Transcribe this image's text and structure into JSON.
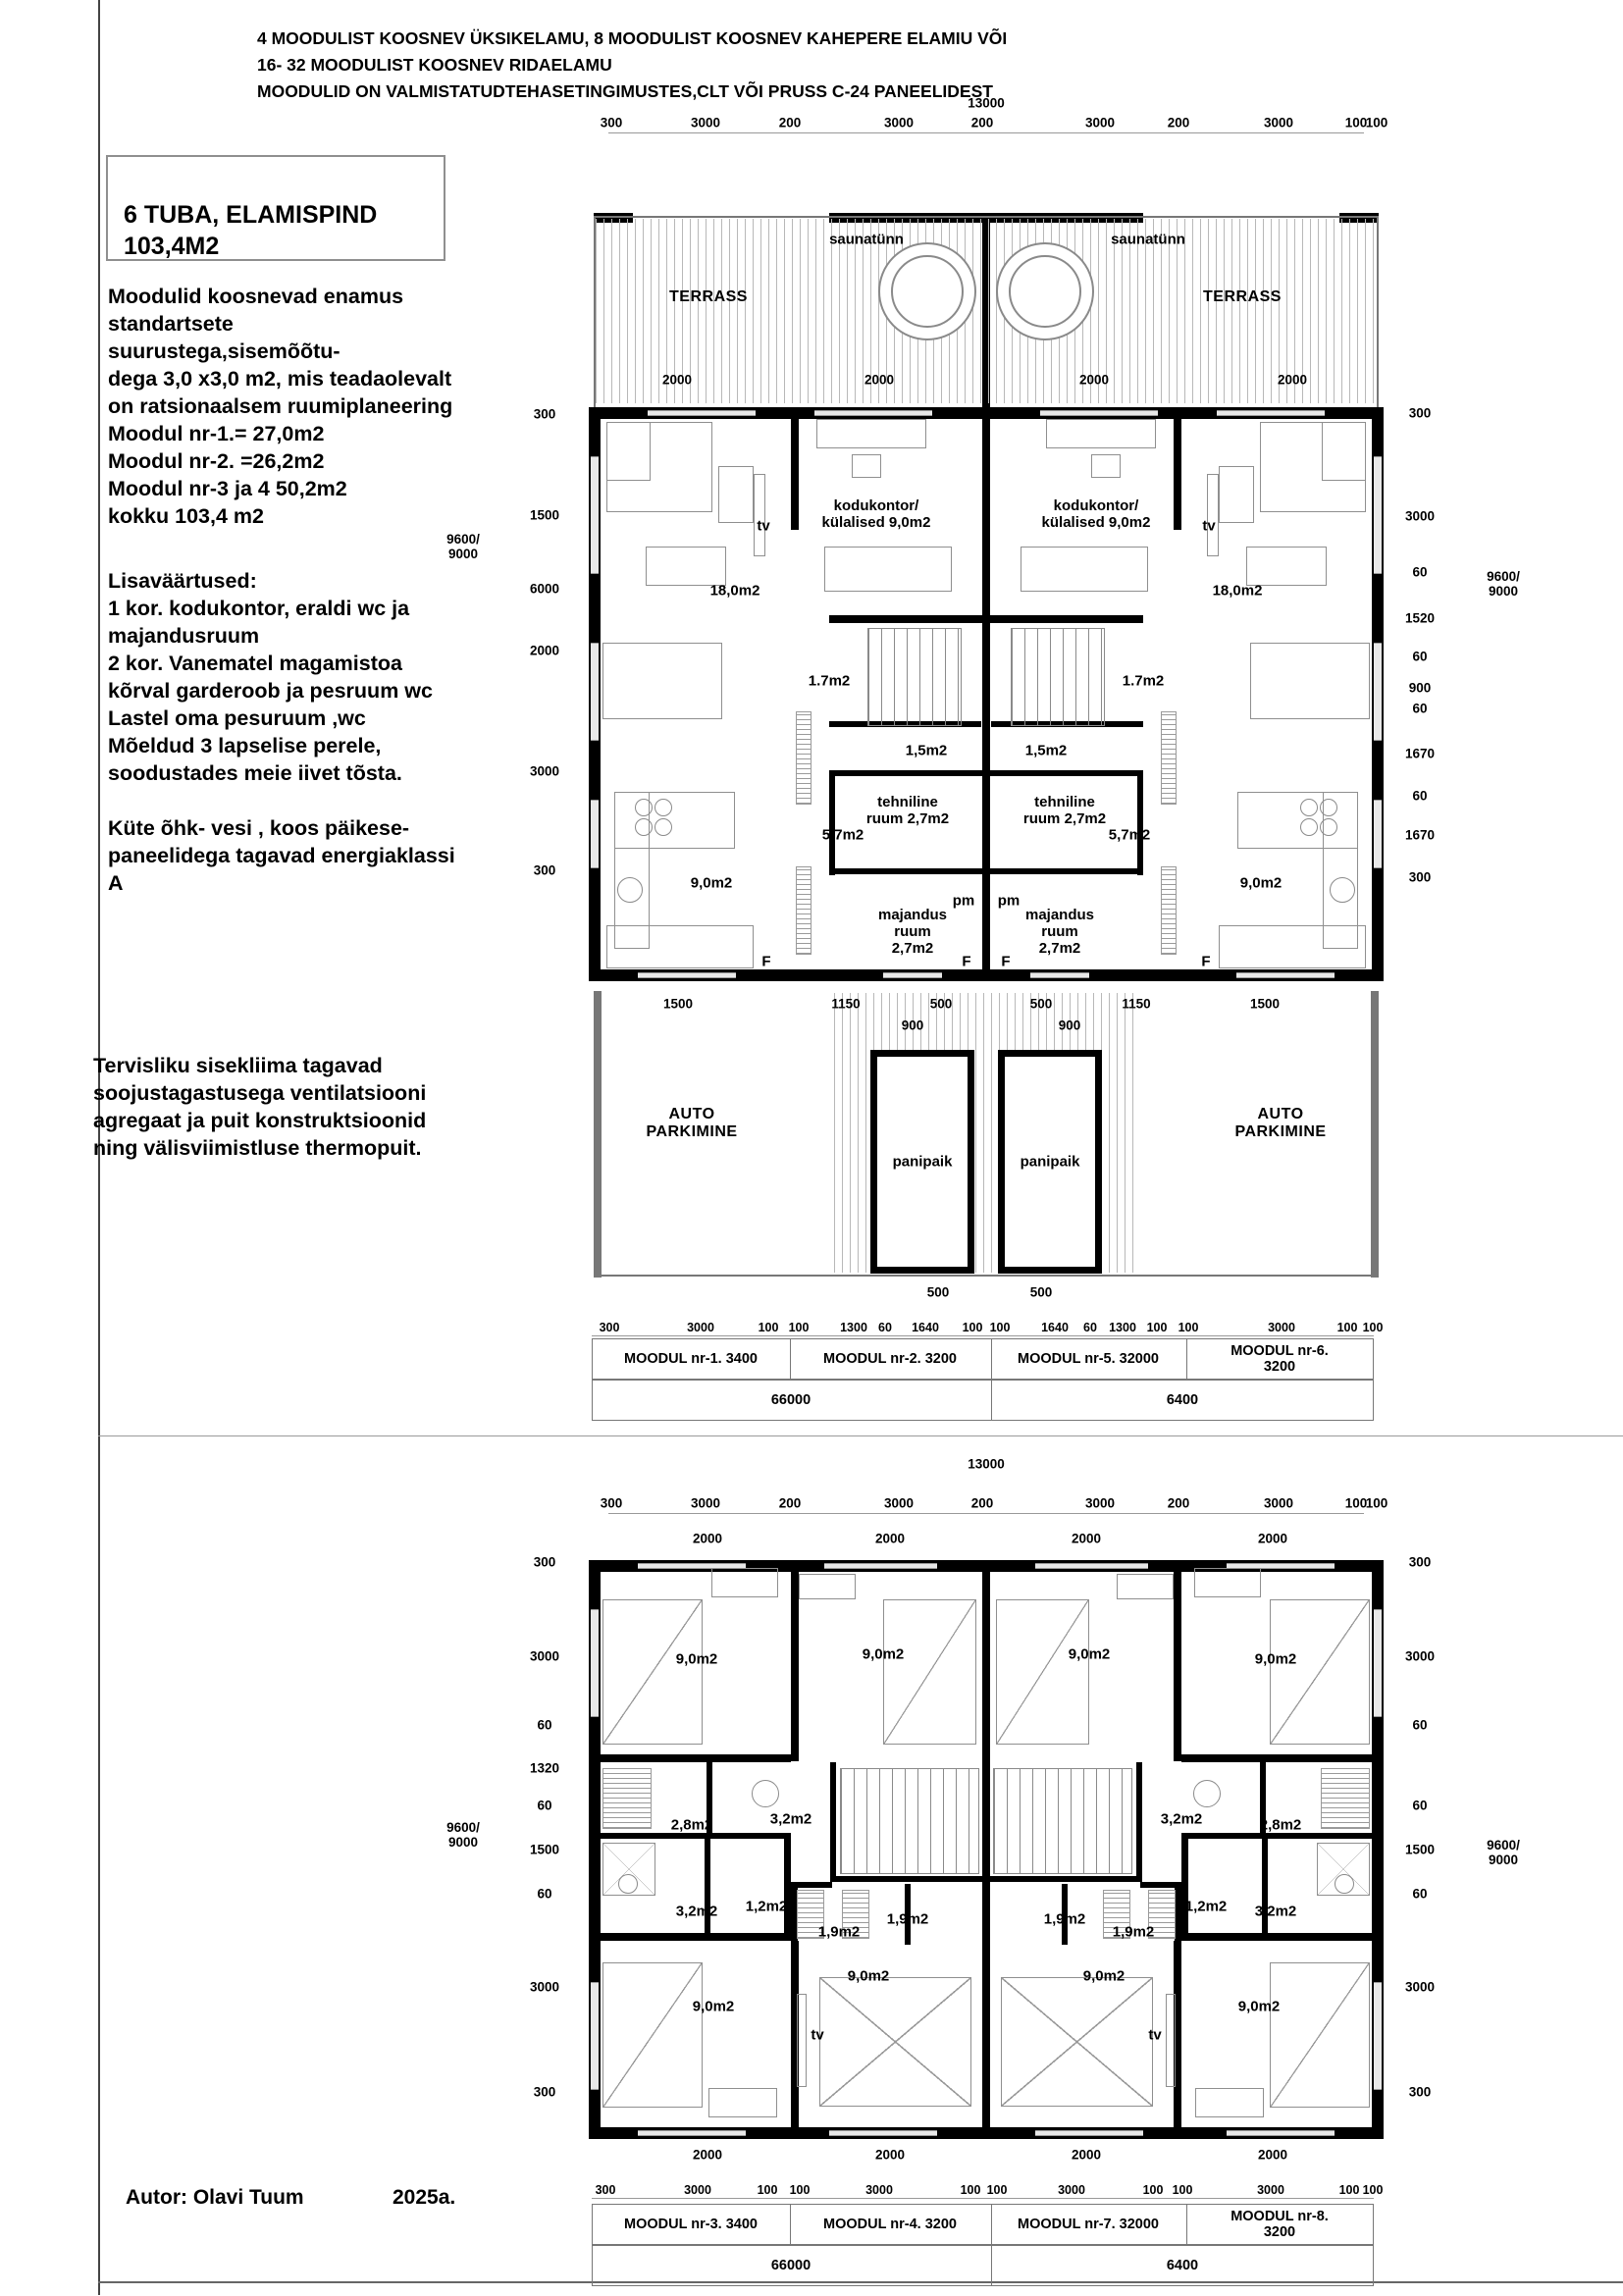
{
  "header": {
    "lines": "4 MOODULIST KOOSNEV ÜKSIKELAMU, 8 MOODULIST KOOSNEV KAHEPERE ELAMIU VÕI\n16- 32 MOODULIST KOOSNEV RIDAELAMU\nMOODULID ON VALMISTATUDTEHASETINGIMUSTES,CLT VÕI PRUSS C-24 PANEELIDEST"
  },
  "info_box": {
    "title": "6 TUBA, ELAMISPIND\n103,4M2"
  },
  "paragraphs": {
    "p1": "Moodulid koosnevad enamus\nstandartsete\nsuurustega,sisemõõtu-\ndega 3,0 x3,0 m2, mis teadaolevalt\non ratsionaalsem ruumiplaneering\nMoodul nr-1.= 27,0m2\nMoodul nr-2. =26,2m2\nMoodul nr-3 ja 4 50,2m2\nkokku 103,4 m2",
    "p2": "Lisaväärtused:\n1 kor. kodukontor, eraldi wc ja\nmajandusruum\n2 kor. Vanematel magamistoa\nkõrval garderoob ja pesruum wc\nLastel oma pesuruum ,wc\nMõeldud 3 lapselise perele,\nsoodustades meie iivet tõsta.\n\nKüte õhk- vesi , koos päikese-\npaneelidega tagavad energiaklassi\nA",
    "p3": "Tervisliku sisekliima tagavad\nsoojustagastusega ventilatsiooni\nagregaat ja puit konstruktsioonid\nning välisviimistluse thermopuit."
  },
  "author": {
    "name": "Autor: Olavi Tuum",
    "year": "2025a."
  },
  "floor1": {
    "overall_width": "13000",
    "top_chain": [
      "300",
      "3000",
      "200",
      "3000",
      "200",
      "3000",
      "200",
      "3000",
      "100",
      "100"
    ],
    "window_dims_top": [
      "2000",
      "2000",
      "2000",
      "2000"
    ],
    "room_labels": [
      "TERRASS",
      "TERRASS",
      "saunatünn",
      "saunatünn",
      "tv",
      "tv",
      "18,0m2",
      "18,0m2",
      "kodukontor/\nkülalised 9,0m2",
      "kodukontor/\nkülalised 9,0m2",
      "1.7m2",
      "1.7m2",
      "1,5m2",
      "1,5m2",
      "tehniline\nruum 2,7m2",
      "tehniline\nruum 2,7m2",
      "5,7m2",
      "5,7m2",
      "9,0m2",
      "9,0m2",
      "majandus\nruum\n2,7m2",
      "majandus\nruum\n2,7m2",
      "pm",
      "pm",
      "F",
      "F",
      "F",
      "F",
      "AUTO\nPARKIMINE",
      "AUTO\nPARKIMINE",
      "panipaik",
      "panipaik"
    ],
    "garage_dims": [
      "1500",
      "1150",
      "500",
      "500",
      "1150",
      "1500"
    ],
    "storage_door_dims": [
      "900",
      "900"
    ],
    "storage_bottom_dims": [
      "500",
      "500"
    ],
    "left_chain": [
      "300",
      "1500",
      "6000",
      "2000",
      "3000",
      "300"
    ],
    "left_total": "9600/\n9000",
    "right_chain": [
      "300",
      "3000",
      "60",
      "1520",
      "60",
      "900",
      "60",
      "1670",
      "60",
      "1670",
      "300"
    ],
    "right_total": "9600/\n9000",
    "bottom_chain": [
      "300",
      "3000",
      "100",
      "100",
      "1300",
      "60",
      "1640",
      "100",
      "100",
      "1640",
      "60",
      "1300",
      "100",
      "100",
      "3000",
      "100",
      "100"
    ],
    "modules": [
      "MOODUL nr-1.   3400",
      "MOODUL nr-2.  3200",
      "MOODUL nr-5.   32000",
      "MOODUL nr-6. 3200"
    ],
    "totals": [
      "66000",
      "6400"
    ]
  },
  "floor2": {
    "overall_width": "13000",
    "top_chain": [
      "300",
      "3000",
      "200",
      "3000",
      "200",
      "3000",
      "200",
      "3000",
      "100",
      "100"
    ],
    "window_dims_top": [
      "2000",
      "2000",
      "2000",
      "2000"
    ],
    "room_labels": [
      "9,0m2",
      "9,0m2",
      "9,0m2",
      "9,0m2",
      "2,8m2",
      "2,8m2",
      "3,2m2",
      "3,2m2",
      "3,2m2",
      "3,2m2",
      "1,2m2",
      "1,2m2",
      "1,9m2",
      "1,9m2",
      "1,9m2",
      "1,9m2",
      "9,0m2",
      "9,0m2",
      "9,0m2",
      "9,0m2",
      "tv",
      "tv"
    ],
    "window_dims_bottom": [
      "2000",
      "2000",
      "2000",
      "2000"
    ],
    "left_chain": [
      "300",
      "3000",
      "60",
      "1320",
      "60",
      "1500",
      "60",
      "3000",
      "300"
    ],
    "left_total": "9600/\n9000",
    "right_chain": [
      "300",
      "3000",
      "60",
      "60",
      "1500",
      "60",
      "3000",
      "300"
    ],
    "right_total": "9600/\n9000",
    "bottom_chain": [
      "300",
      "3000",
      "100",
      "100",
      "3000",
      "100",
      "100",
      "3000",
      "100",
      "100",
      "3000",
      "100",
      "100"
    ],
    "modules": [
      "MOODUL nr-3.   3400",
      "MOODUL nr-4.  3200",
      "MOODUL nr-7.   32000",
      "MOODUL nr-8. 3200"
    ],
    "totals": [
      "66000",
      "6400"
    ]
  }
}
